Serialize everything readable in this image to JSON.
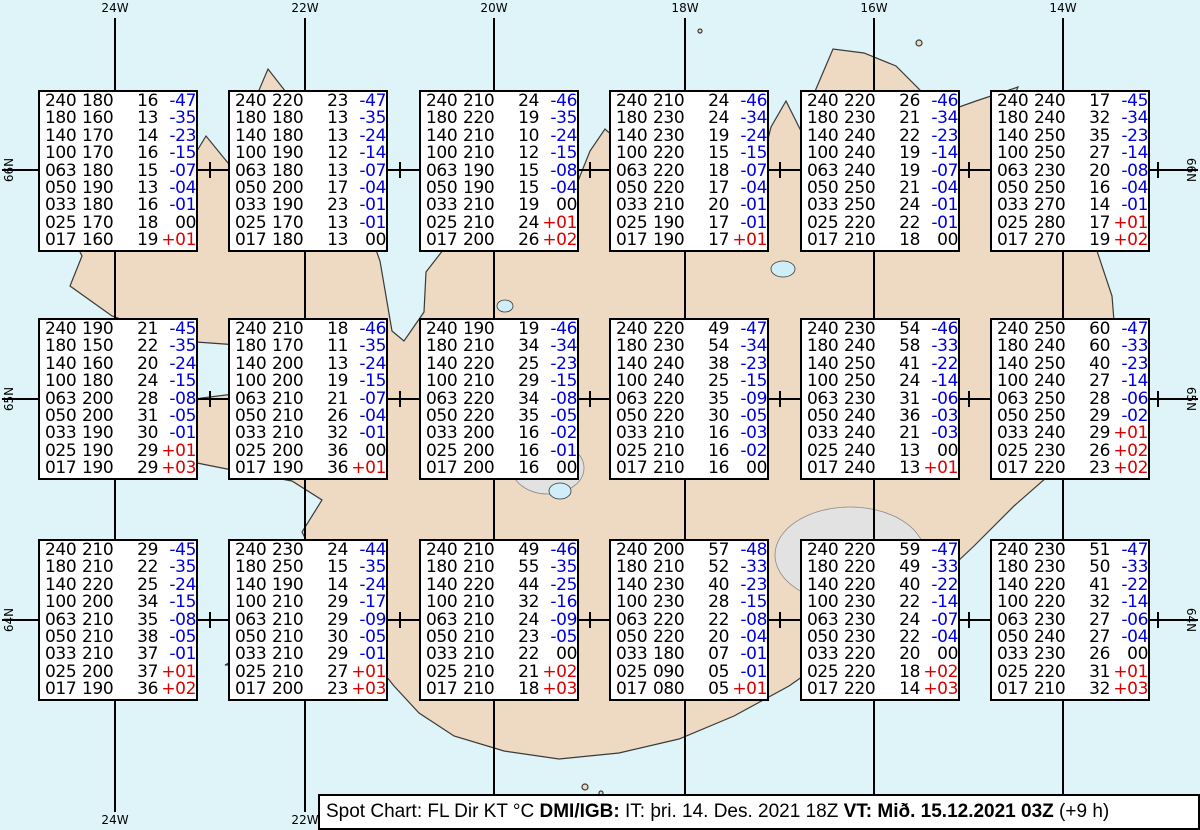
{
  "title": "Spot Chart Iceland",
  "caption": {
    "text_1": "Spot Chart: FL Dir KT °C ",
    "bold_1": "DMI/IGB:",
    "text_2": " IT: þri. 14. Des. 2021 18Z ",
    "bold_2": "VT: Mið. 15.12.2021 03Z",
    "text_3": " (+9 h)"
  },
  "grid": {
    "longitude_labels": [
      "24W",
      "22W",
      "20W",
      "18W",
      "16W",
      "14W"
    ],
    "latitude_labels": [
      "66N",
      "65N",
      "64N"
    ]
  },
  "columns": [
    "FL",
    "Dir",
    "KT",
    "°C"
  ],
  "colors": {
    "temp_negative": "#0000dd",
    "temp_zero": "#000000",
    "temp_positive": "#dd0000"
  },
  "map": {
    "colors": {
      "sea": "#dff4f9",
      "land": "#eed9c2",
      "lake": "#cfeef7",
      "glacier": "#e2e2e2"
    }
  },
  "stations": [
    {
      "lat": "66N",
      "lon": "24W",
      "rows": [
        [
          "240",
          "180",
          "16",
          "-47"
        ],
        [
          "180",
          "160",
          "13",
          "-35"
        ],
        [
          "140",
          "170",
          "14",
          "-23"
        ],
        [
          "100",
          "170",
          "16",
          "-15"
        ],
        [
          "063",
          "180",
          "15",
          "-07"
        ],
        [
          "050",
          "190",
          "13",
          "-04"
        ],
        [
          "033",
          "180",
          "16",
          "-01"
        ],
        [
          "025",
          "170",
          "18",
          "00"
        ],
        [
          "017",
          "160",
          "19",
          "+01"
        ]
      ]
    },
    {
      "lat": "66N",
      "lon": "22W",
      "rows": [
        [
          "240",
          "220",
          "23",
          "-47"
        ],
        [
          "180",
          "180",
          "13",
          "-35"
        ],
        [
          "140",
          "180",
          "13",
          "-24"
        ],
        [
          "100",
          "190",
          "12",
          "-14"
        ],
        [
          "063",
          "180",
          "13",
          "-07"
        ],
        [
          "050",
          "200",
          "17",
          "-04"
        ],
        [
          "033",
          "190",
          "23",
          "-01"
        ],
        [
          "025",
          "170",
          "13",
          "-01"
        ],
        [
          "017",
          "180",
          "13",
          "00"
        ]
      ]
    },
    {
      "lat": "66N",
      "lon": "20W",
      "rows": [
        [
          "240",
          "210",
          "24",
          "-46"
        ],
        [
          "180",
          "220",
          "19",
          "-35"
        ],
        [
          "140",
          "210",
          "10",
          "-24"
        ],
        [
          "100",
          "210",
          "12",
          "-15"
        ],
        [
          "063",
          "190",
          "15",
          "-08"
        ],
        [
          "050",
          "190",
          "15",
          "-04"
        ],
        [
          "033",
          "210",
          "19",
          "00"
        ],
        [
          "025",
          "210",
          "24",
          "+01"
        ],
        [
          "017",
          "200",
          "26",
          "+02"
        ]
      ]
    },
    {
      "lat": "66N",
      "lon": "18W",
      "rows": [
        [
          "240",
          "210",
          "24",
          "-46"
        ],
        [
          "180",
          "230",
          "24",
          "-34"
        ],
        [
          "140",
          "230",
          "19",
          "-24"
        ],
        [
          "100",
          "220",
          "15",
          "-15"
        ],
        [
          "063",
          "220",
          "18",
          "-07"
        ],
        [
          "050",
          "220",
          "17",
          "-04"
        ],
        [
          "033",
          "210",
          "20",
          "-01"
        ],
        [
          "025",
          "190",
          "17",
          "-01"
        ],
        [
          "017",
          "190",
          "17",
          "+01"
        ]
      ]
    },
    {
      "lat": "66N",
      "lon": "16W",
      "rows": [
        [
          "240",
          "220",
          "26",
          "-46"
        ],
        [
          "180",
          "230",
          "21",
          "-34"
        ],
        [
          "140",
          "240",
          "22",
          "-23"
        ],
        [
          "100",
          "240",
          "19",
          "-14"
        ],
        [
          "063",
          "240",
          "19",
          "-07"
        ],
        [
          "050",
          "250",
          "21",
          "-04"
        ],
        [
          "033",
          "250",
          "24",
          "-01"
        ],
        [
          "025",
          "220",
          "22",
          "-01"
        ],
        [
          "017",
          "210",
          "18",
          "00"
        ]
      ]
    },
    {
      "lat": "66N",
      "lon": "14W",
      "rows": [
        [
          "240",
          "240",
          "17",
          "-45"
        ],
        [
          "180",
          "240",
          "32",
          "-34"
        ],
        [
          "140",
          "250",
          "35",
          "-23"
        ],
        [
          "100",
          "250",
          "27",
          "-14"
        ],
        [
          "063",
          "230",
          "20",
          "-08"
        ],
        [
          "050",
          "250",
          "16",
          "-04"
        ],
        [
          "033",
          "270",
          "14",
          "-01"
        ],
        [
          "025",
          "280",
          "17",
          "+01"
        ],
        [
          "017",
          "270",
          "19",
          "+02"
        ]
      ]
    },
    {
      "lat": "65N",
      "lon": "24W",
      "rows": [
        [
          "240",
          "190",
          "21",
          "-45"
        ],
        [
          "180",
          "150",
          "22",
          "-35"
        ],
        [
          "140",
          "160",
          "20",
          "-24"
        ],
        [
          "100",
          "180",
          "24",
          "-15"
        ],
        [
          "063",
          "200",
          "28",
          "-08"
        ],
        [
          "050",
          "200",
          "31",
          "-05"
        ],
        [
          "033",
          "190",
          "30",
          "-01"
        ],
        [
          "025",
          "190",
          "29",
          "+01"
        ],
        [
          "017",
          "190",
          "29",
          "+03"
        ]
      ]
    },
    {
      "lat": "65N",
      "lon": "22W",
      "rows": [
        [
          "240",
          "210",
          "18",
          "-46"
        ],
        [
          "180",
          "170",
          "11",
          "-35"
        ],
        [
          "140",
          "200",
          "13",
          "-24"
        ],
        [
          "100",
          "200",
          "19",
          "-15"
        ],
        [
          "063",
          "210",
          "21",
          "-07"
        ],
        [
          "050",
          "210",
          "26",
          "-04"
        ],
        [
          "033",
          "210",
          "32",
          "-01"
        ],
        [
          "025",
          "200",
          "36",
          "00"
        ],
        [
          "017",
          "190",
          "36",
          "+01"
        ]
      ]
    },
    {
      "lat": "65N",
      "lon": "20W",
      "rows": [
        [
          "240",
          "190",
          "19",
          "-46"
        ],
        [
          "180",
          "210",
          "34",
          "-34"
        ],
        [
          "140",
          "220",
          "25",
          "-23"
        ],
        [
          "100",
          "210",
          "29",
          "-15"
        ],
        [
          "063",
          "220",
          "34",
          "-08"
        ],
        [
          "050",
          "220",
          "35",
          "-05"
        ],
        [
          "033",
          "200",
          "16",
          "-02"
        ],
        [
          "025",
          "200",
          "16",
          "-01"
        ],
        [
          "017",
          "200",
          "16",
          "00"
        ]
      ]
    },
    {
      "lat": "65N",
      "lon": "18W",
      "rows": [
        [
          "240",
          "220",
          "49",
          "-47"
        ],
        [
          "180",
          "230",
          "54",
          "-34"
        ],
        [
          "140",
          "240",
          "38",
          "-23"
        ],
        [
          "100",
          "240",
          "25",
          "-15"
        ],
        [
          "063",
          "220",
          "35",
          "-09"
        ],
        [
          "050",
          "220",
          "30",
          "-05"
        ],
        [
          "033",
          "210",
          "16",
          "-03"
        ],
        [
          "025",
          "210",
          "16",
          "-02"
        ],
        [
          "017",
          "210",
          "16",
          "00"
        ]
      ]
    },
    {
      "lat": "65N",
      "lon": "16W",
      "rows": [
        [
          "240",
          "230",
          "54",
          "-46"
        ],
        [
          "180",
          "240",
          "58",
          "-33"
        ],
        [
          "140",
          "250",
          "41",
          "-22"
        ],
        [
          "100",
          "250",
          "24",
          "-14"
        ],
        [
          "063",
          "230",
          "31",
          "-06"
        ],
        [
          "050",
          "240",
          "36",
          "-03"
        ],
        [
          "033",
          "240",
          "21",
          "-03"
        ],
        [
          "025",
          "240",
          "13",
          "00"
        ],
        [
          "017",
          "240",
          "13",
          "+01"
        ]
      ]
    },
    {
      "lat": "65N",
      "lon": "14W",
      "rows": [
        [
          "240",
          "250",
          "60",
          "-47"
        ],
        [
          "180",
          "240",
          "60",
          "-33"
        ],
        [
          "140",
          "250",
          "40",
          "-23"
        ],
        [
          "100",
          "240",
          "27",
          "-14"
        ],
        [
          "063",
          "250",
          "28",
          "-06"
        ],
        [
          "050",
          "250",
          "29",
          "-02"
        ],
        [
          "033",
          "240",
          "29",
          "+01"
        ],
        [
          "025",
          "230",
          "26",
          "+02"
        ],
        [
          "017",
          "220",
          "23",
          "+02"
        ]
      ]
    },
    {
      "lat": "64N",
      "lon": "24W",
      "rows": [
        [
          "240",
          "210",
          "29",
          "-45"
        ],
        [
          "180",
          "210",
          "22",
          "-35"
        ],
        [
          "140",
          "220",
          "25",
          "-24"
        ],
        [
          "100",
          "200",
          "34",
          "-15"
        ],
        [
          "063",
          "210",
          "35",
          "-08"
        ],
        [
          "050",
          "210",
          "38",
          "-05"
        ],
        [
          "033",
          "210",
          "37",
          "-01"
        ],
        [
          "025",
          "200",
          "37",
          "+01"
        ],
        [
          "017",
          "190",
          "36",
          "+02"
        ]
      ]
    },
    {
      "lat": "64N",
      "lon": "22W",
      "rows": [
        [
          "240",
          "230",
          "24",
          "-44"
        ],
        [
          "180",
          "250",
          "15",
          "-35"
        ],
        [
          "140",
          "190",
          "14",
          "-24"
        ],
        [
          "100",
          "210",
          "29",
          "-17"
        ],
        [
          "063",
          "210",
          "29",
          "-09"
        ],
        [
          "050",
          "210",
          "30",
          "-05"
        ],
        [
          "033",
          "210",
          "29",
          "-01"
        ],
        [
          "025",
          "210",
          "27",
          "+01"
        ],
        [
          "017",
          "200",
          "23",
          "+03"
        ]
      ]
    },
    {
      "lat": "64N",
      "lon": "20W",
      "rows": [
        [
          "240",
          "210",
          "49",
          "-46"
        ],
        [
          "180",
          "210",
          "55",
          "-35"
        ],
        [
          "140",
          "220",
          "44",
          "-25"
        ],
        [
          "100",
          "210",
          "32",
          "-16"
        ],
        [
          "063",
          "210",
          "24",
          "-09"
        ],
        [
          "050",
          "210",
          "23",
          "-05"
        ],
        [
          "033",
          "210",
          "22",
          "00"
        ],
        [
          "025",
          "210",
          "21",
          "+02"
        ],
        [
          "017",
          "210",
          "18",
          "+03"
        ]
      ]
    },
    {
      "lat": "64N",
      "lon": "18W",
      "rows": [
        [
          "240",
          "200",
          "57",
          "-48"
        ],
        [
          "180",
          "210",
          "52",
          "-33"
        ],
        [
          "140",
          "230",
          "40",
          "-23"
        ],
        [
          "100",
          "230",
          "28",
          "-15"
        ],
        [
          "063",
          "220",
          "22",
          "-08"
        ],
        [
          "050",
          "220",
          "20",
          "-04"
        ],
        [
          "033",
          "180",
          "07",
          "-01"
        ],
        [
          "025",
          "090",
          "05",
          "-01"
        ],
        [
          "017",
          "080",
          "05",
          "+01"
        ]
      ]
    },
    {
      "lat": "64N",
      "lon": "16W",
      "rows": [
        [
          "240",
          "220",
          "59",
          "-47"
        ],
        [
          "180",
          "220",
          "49",
          "-33"
        ],
        [
          "140",
          "220",
          "40",
          "-22"
        ],
        [
          "100",
          "230",
          "22",
          "-14"
        ],
        [
          "063",
          "230",
          "24",
          "-07"
        ],
        [
          "050",
          "230",
          "22",
          "-04"
        ],
        [
          "033",
          "220",
          "20",
          "00"
        ],
        [
          "025",
          "220",
          "18",
          "+02"
        ],
        [
          "017",
          "220",
          "14",
          "+03"
        ]
      ]
    },
    {
      "lat": "64N",
      "lon": "14W",
      "rows": [
        [
          "240",
          "230",
          "51",
          "-47"
        ],
        [
          "180",
          "230",
          "50",
          "-33"
        ],
        [
          "140",
          "220",
          "41",
          "-22"
        ],
        [
          "100",
          "220",
          "32",
          "-14"
        ],
        [
          "063",
          "230",
          "27",
          "-06"
        ],
        [
          "050",
          "240",
          "27",
          "-04"
        ],
        [
          "033",
          "230",
          "26",
          "00"
        ],
        [
          "025",
          "220",
          "31",
          "+01"
        ],
        [
          "017",
          "210",
          "32",
          "+03"
        ]
      ]
    }
  ]
}
